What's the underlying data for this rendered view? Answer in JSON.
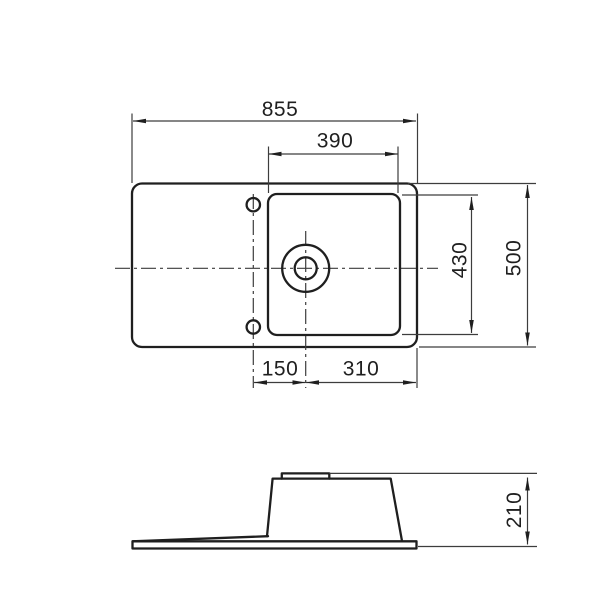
{
  "page": {
    "kind": "sink technical drawing",
    "background": "#ffffff",
    "line_color": "#1f1f1f",
    "thin_line_color": "#3d3d3d"
  },
  "drawing": {
    "views": {
      "top": {
        "name": "plan view of sink with drainboard",
        "dims": {
          "overall_width": "855",
          "bowl_width": "390",
          "bowl_depth": "430",
          "overall_depth": "500",
          "holes_to_drain": "150",
          "drain_to_right_edge": "310"
        }
      },
      "side": {
        "name": "side elevation of sink",
        "dims": {
          "overall_height": "210"
        }
      }
    }
  }
}
